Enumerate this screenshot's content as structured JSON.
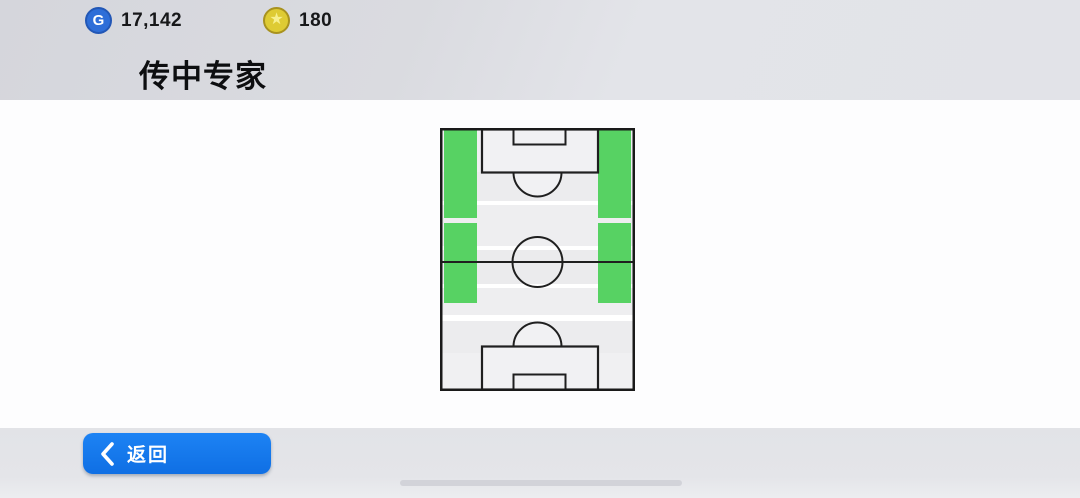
{
  "header": {
    "title": "传中专家",
    "gp": {
      "icon": "gp-coin-icon",
      "letter": "G",
      "value": "17,142"
    },
    "stars": {
      "icon": "star-coin-icon",
      "glyph": "★",
      "value": "180"
    }
  },
  "main": {
    "pitch": {
      "type": "skill-effective-area-map",
      "description_zones_units": "px within 195x263 pitch",
      "highlight_color": "#57d263",
      "zones": [
        {
          "name": "left-wing-upper",
          "x": 4,
          "y": 2,
          "w": 33,
          "h": 88
        },
        {
          "name": "left-wing-lower",
          "x": 4,
          "y": 95,
          "w": 33,
          "h": 80
        },
        {
          "name": "right-wing-upper",
          "x": 158,
          "y": 2,
          "w": 33,
          "h": 88
        },
        {
          "name": "right-wing-lower",
          "x": 158,
          "y": 95,
          "w": 33,
          "h": 80
        }
      ]
    }
  },
  "footer": {
    "back_button": {
      "icon": "chevron-left-icon",
      "label": "返回"
    }
  },
  "colors": {
    "accent_blue": "#1677ec",
    "zone_green": "#57d263",
    "gp_coin_blue": "#2e6ed8",
    "star_coin_gold": "#decb33",
    "pitch_line": "#1f1f1f",
    "panel_white": "#fdfdfe",
    "chrome_gray": "#e1e2e7"
  }
}
